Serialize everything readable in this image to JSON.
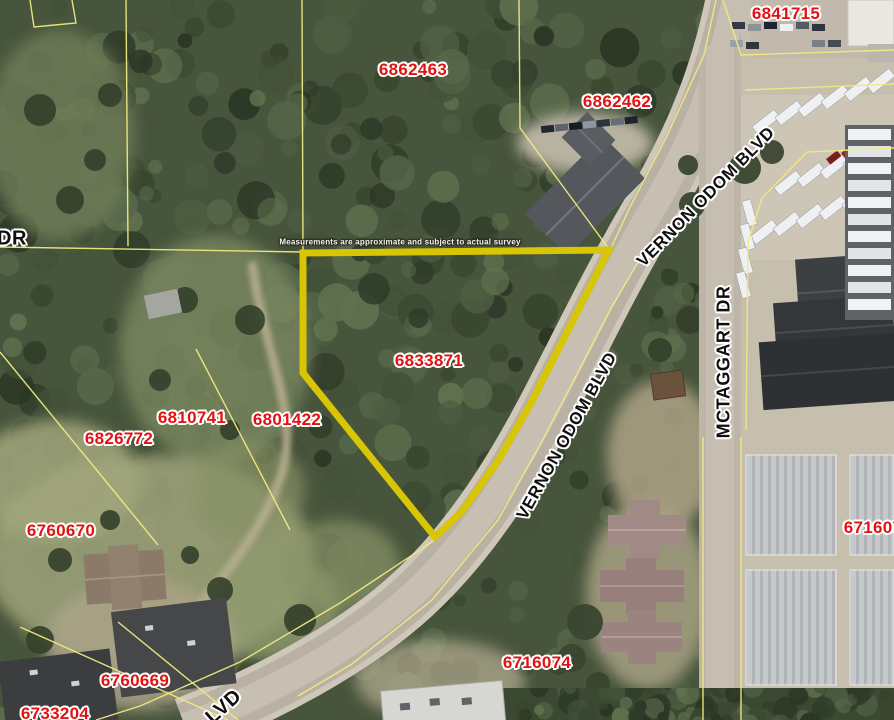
{
  "map": {
    "disclaimer": "Measurements are approximate and subject to actual survey",
    "parcels": [
      "6841715",
      "6862463",
      "6862462",
      "6833871",
      "6810741",
      "6801422",
      "6826772",
      "6760670",
      "6716074",
      "671607",
      "6760669",
      "6733204"
    ],
    "road_labels": [
      "VERNON ODOM BLVD",
      "VERNON ODOM BLVD",
      "MCTAGGART DR",
      "DR",
      "LVD"
    ],
    "highlighted_parcel": "6833871",
    "colors": {
      "highlight_outline": "#d8c503",
      "parcel_line": "#f1ea7f",
      "parcel_label": "#e31212",
      "road_label": "#0f0f0f"
    }
  }
}
